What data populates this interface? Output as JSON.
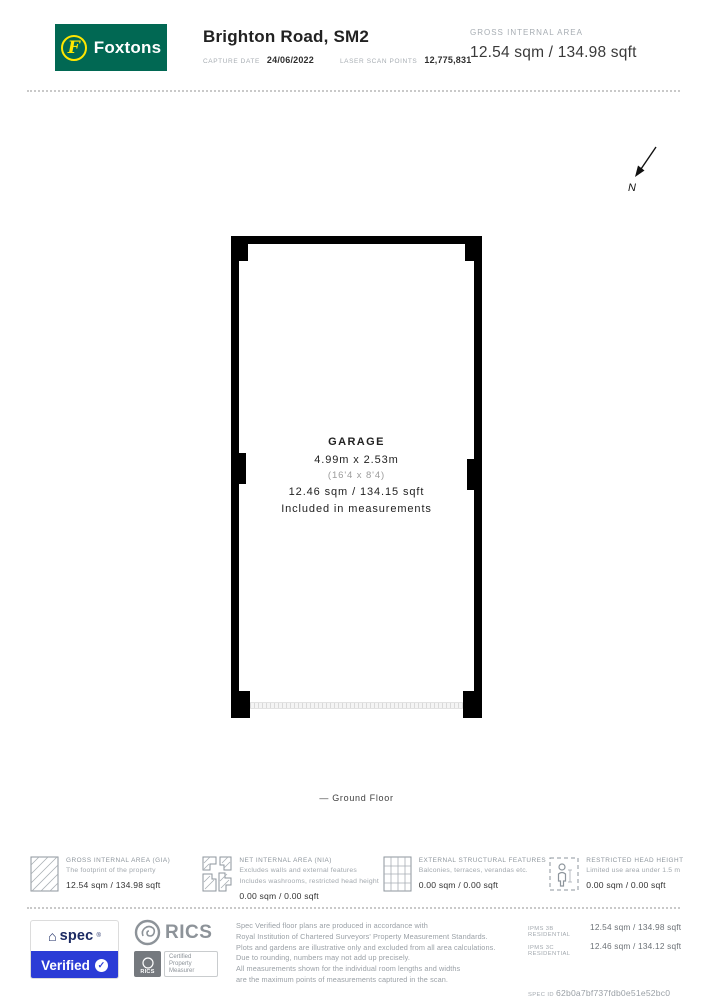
{
  "header": {
    "brand": "Foxtons",
    "title": "Brighton Road, SM2",
    "capture_date_label": "CAPTURE DATE",
    "capture_date": "24/06/2022",
    "laser_label": "LASER SCAN POINTS",
    "laser_points": "12,775,831",
    "gia_label": "GROSS INTERNAL AREA",
    "gia_value": "12.54 sqm / 134.98 sqft"
  },
  "compass": {
    "label": "N"
  },
  "floorplan": {
    "room": {
      "name": "GARAGE",
      "dims_metric": "4.99m x 2.53m",
      "dims_imperial": "(16'4 x 8'4)",
      "area": "12.46 sqm / 134.15 sqft",
      "note": "Included in measurements"
    },
    "floor_label": "— Ground Floor"
  },
  "legend": {
    "items": [
      {
        "icon": "diagonal-hatch-icon",
        "title": "GROSS INTERNAL AREA (GIA)",
        "line1": "The footprint of the property",
        "line2": "",
        "value": "12.54 sqm / 134.98 sqft"
      },
      {
        "icon": "wall-hatch-icon",
        "title": "NET INTERNAL AREA (NIA)",
        "line1": "Excludes walls and external features",
        "line2": "Includes washrooms, restricted head height",
        "value": "0.00 sqm / 0.00 sqft"
      },
      {
        "icon": "grid-icon",
        "title": "EXTERNAL STRUCTURAL FEATURES",
        "line1": "Balconies, terraces, verandas etc.",
        "line2": "",
        "value": "0.00 sqm / 0.00 sqft"
      },
      {
        "icon": "person-dashed-icon",
        "title": "RESTRICTED HEAD HEIGHT",
        "line1": "Limited use area under 1.5 m",
        "line2": "",
        "value": "0.00 sqm / 0.00 sqft"
      }
    ]
  },
  "footer": {
    "spec_badge": {
      "brand": "spec",
      "mark": "®",
      "verified": "Verified"
    },
    "rics": {
      "name": "RICS",
      "mini_name": "RICS",
      "badge_line1": "Certified",
      "badge_line2": "Property",
      "badge_line3": "Measurer"
    },
    "disclaimer": [
      "Spec Verified floor plans are produced in accordance with",
      "Royal Institution of Chartered Surveyors' Property Measurement Standards.",
      "Plots and gardens are illustrative only and excluded from all area calculations.",
      "Due to rounding, numbers may not add up precisely.",
      "All measurements shown for the individual room lengths and widths",
      "are the maximum points of measurements captured in the scan."
    ],
    "ipms": [
      {
        "label": "IPMS 3B RESIDENTIAL",
        "value": "12.54 sqm / 134.98 sqft"
      },
      {
        "label": "IPMS 3C RESIDENTIAL",
        "value": "12.46 sqm / 134.12 sqft"
      }
    ],
    "spec_id_label": "SPEC ID",
    "spec_id": "62b0a7bf737fdb0e51e52bc0"
  },
  "icons": {
    "house": "⌂",
    "check": "✓",
    "f_initial": "F"
  },
  "colors": {
    "brand_green": "#016853",
    "logo_yellow": "#ffe600",
    "verified_blue": "#2b3cd6",
    "wall_black": "#000000"
  }
}
